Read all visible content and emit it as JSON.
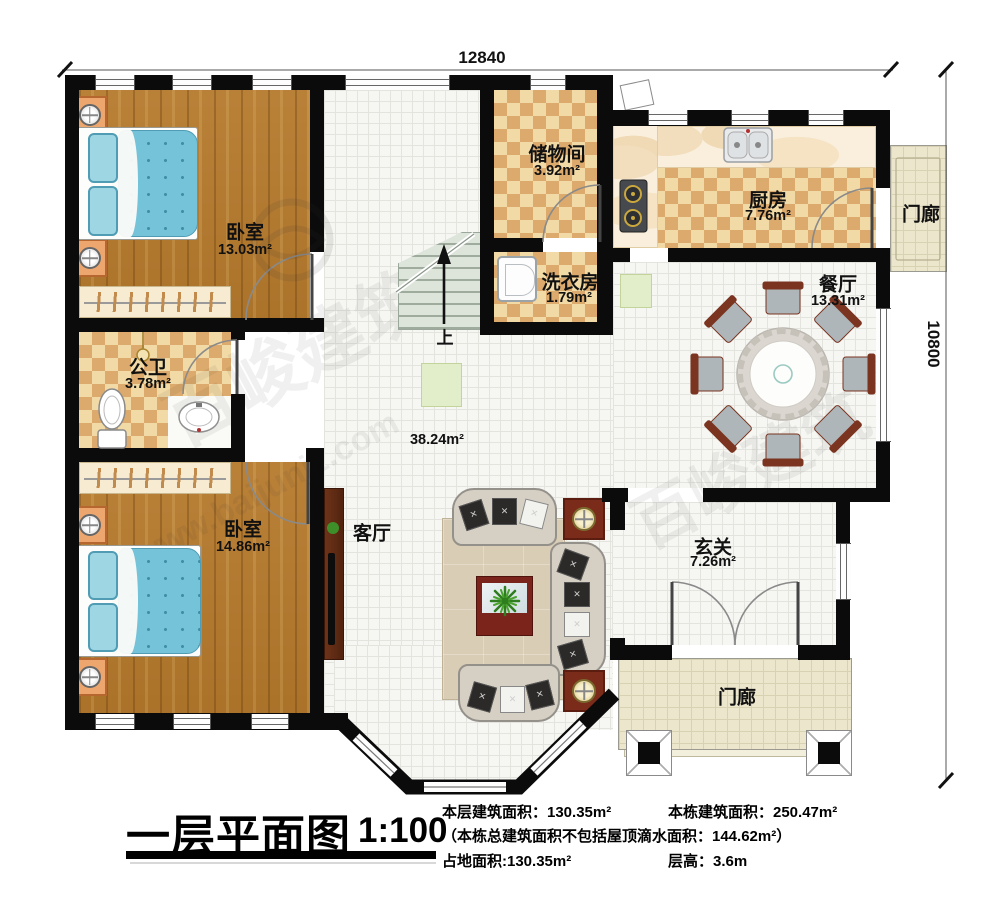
{
  "dimensions": {
    "top": "12840",
    "right": "10800"
  },
  "rooms": {
    "bedroom1": {
      "label": "卧室",
      "area": "13.03m²"
    },
    "storage": {
      "label": "储物间",
      "area": "3.92m²"
    },
    "kitchen": {
      "label": "厨房",
      "area": "7.76m²"
    },
    "porch_right": {
      "label": "门廊"
    },
    "laundry": {
      "label": "洗衣房",
      "area": "1.79m²"
    },
    "dining": {
      "label": "餐厅",
      "area": "13.31m²"
    },
    "bath": {
      "label": "公卫",
      "area": "3.78m²"
    },
    "bedroom2": {
      "label": "卧室",
      "area": "14.86m²"
    },
    "living": {
      "label": "客厅",
      "area": "38.24m²"
    },
    "entry": {
      "label": "玄关",
      "area": "7.26m²"
    },
    "porch_bottom": {
      "label": "门廊"
    }
  },
  "stairs": {
    "up": "上"
  },
  "titleblock": {
    "title": "一层平面图",
    "scale": "1:100",
    "stats_line1a": "本层建筑面积：130.35m²",
    "stats_line1b": "本栋建筑面积：250.47m²",
    "stats_line2": "（本栋总建筑面积不包括屋顶滴水面积：144.62m²）",
    "stats_line3a": "占地面积:130.35m²",
    "stats_line3b": "层高：3.6m"
  },
  "watermark": {
    "brand": "百峻建筑",
    "url": "www.baijunjz.com"
  },
  "colors": {
    "wall": "#0b0b0b",
    "wood_floor": "#b5792c",
    "checker_light": "#f2daa6",
    "checker_dark": "#dcaa6c",
    "tile_white": "#f6f6f3",
    "porch_beige": "#ece6cd",
    "bed_blue": "#74c3d8",
    "accent_wood_dark": "#7b2b1a"
  }
}
